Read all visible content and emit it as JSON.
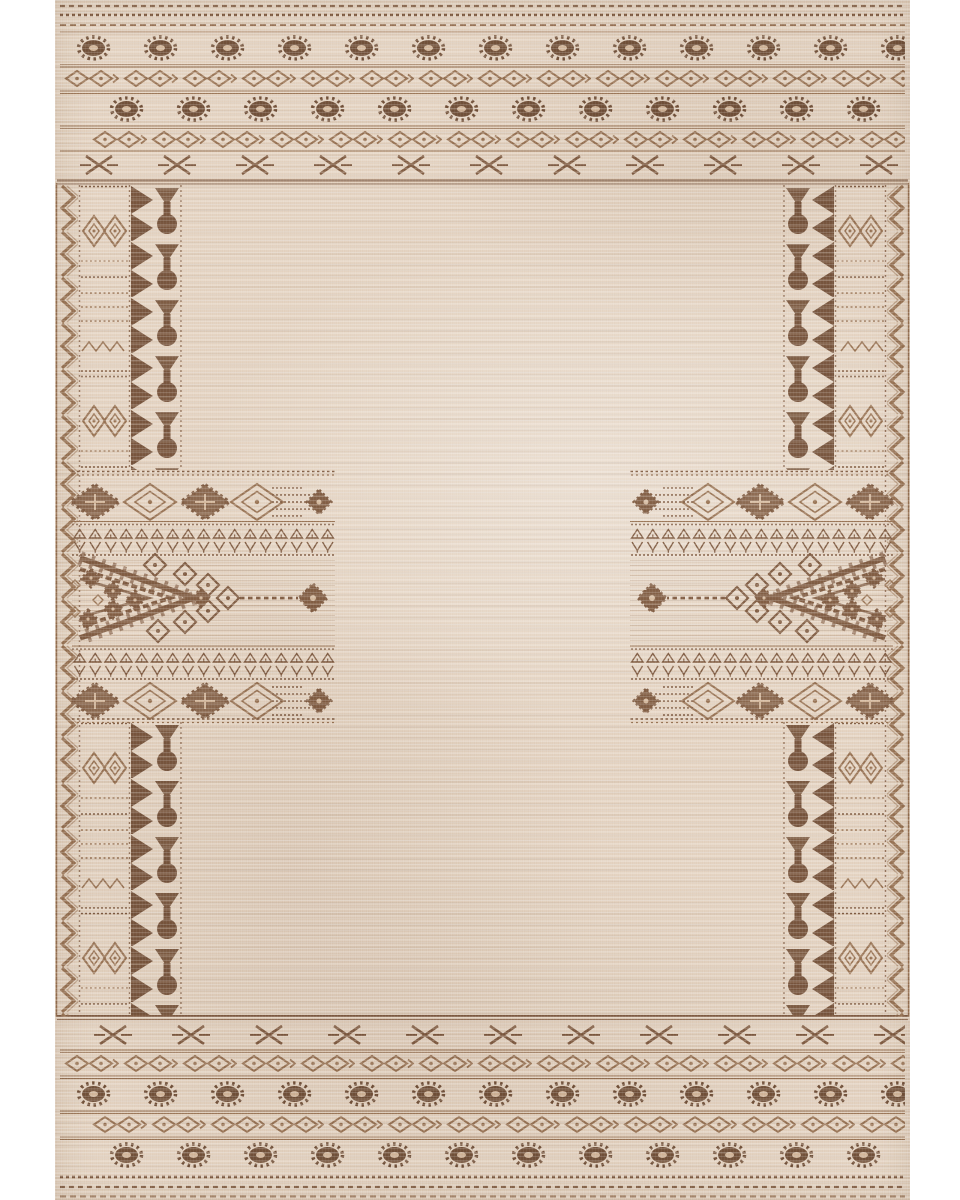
{
  "description": "Product photo of a rectangular Moroccan tribal-style area rug in beige with brown geometric kilim motifs, shown flat on a white background",
  "canvas": {
    "width_px": 960,
    "height_px": 1200
  },
  "rug": {
    "style": "Moroccan tribal kilim print rug",
    "orientation": "vertical",
    "bounds": {
      "left_px": 55,
      "top_px": 0,
      "right_px": 910,
      "bottom_px": 1200
    },
    "palette": {
      "page_bg": "#ffffff",
      "field": "#e2d0bd",
      "field_light": "#ecdccb",
      "field_dark": "#d5bfa8",
      "line_light": "#b49579",
      "motif_light": "#a9886b",
      "motif_mid": "#8d6b52",
      "motif_dark": "#7b5b44",
      "tassel": "#82624b"
    },
    "regions": {
      "top_border": "dotted stitch rows, two rows of notched oval eye motifs, two diamond-chain rows, row of X stitch motifs",
      "bottom_border": "mirror of top border: X stitch row, diamond-chain rows, notched oval eye rows, dotted stitch rows",
      "left_border": "zigzag selvedge column, banded rectangle column with concentric diamond eyes, dark triangle-and-teardrop tassel column",
      "right_border": "mirror image of the left border",
      "left_band": "horizontal panel with diamond medallions, comb arrow, tiny glyph lattice rows and a large stepped chevron pointing right with diamond echoes and a dotted tail ending in a stepped rosette",
      "right_band": "mirror image of the left band, chevron pointing left",
      "field": "plain mottled beige woven ground"
    },
    "motif_legend": [
      "notched-oval-eye",
      "diamond-chain",
      "x-stitch",
      "zigzag-selvedge",
      "triangle-teardrop-tassel",
      "concentric-diamond-eye",
      "stepped-diamond-medallion",
      "outlined-diamond-medallion",
      "comb-arrow",
      "glyph-lattice",
      "stepped-chevron",
      "diamond-echo",
      "stepped-rosette"
    ]
  }
}
